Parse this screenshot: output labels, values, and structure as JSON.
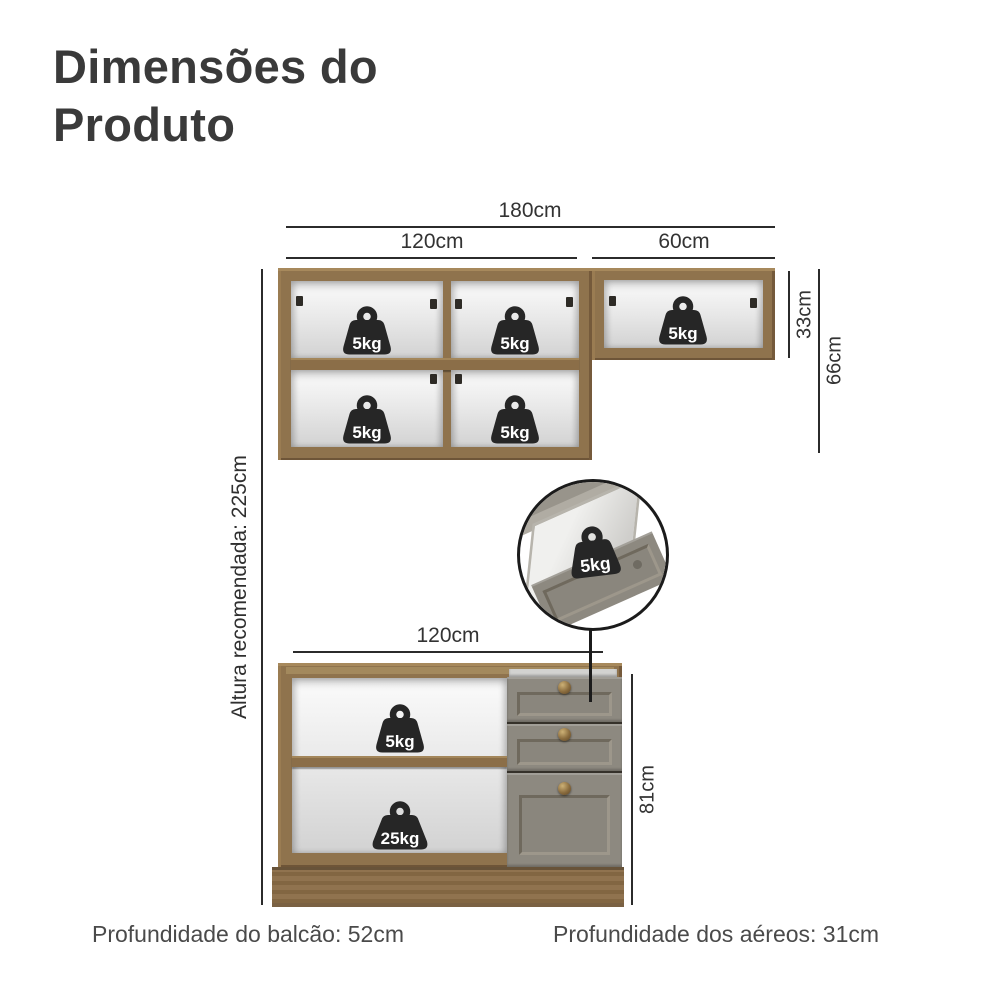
{
  "title": "Dimensões do Produto",
  "upper_cabinet": {
    "dims": {
      "total_width": "180cm",
      "left_width": "120cm",
      "right_width": "60cm",
      "right_height": "33cm",
      "total_height": "66cm"
    },
    "weights": [
      "5kg",
      "5kg",
      "5kg",
      "5kg",
      "5kg"
    ]
  },
  "side_note": "Altura recomendada: 225cm",
  "inset": {
    "weight": "5kg"
  },
  "lower_cabinet": {
    "dims": {
      "width": "120cm",
      "height": "81cm"
    },
    "weights": [
      "5kg",
      "25kg"
    ],
    "drawer_count": 3
  },
  "footer": {
    "counter_depth": "Profundidade do balcão: 52cm",
    "aerial_depth": "Profundidade dos aéreos: 31cm"
  },
  "colors": {
    "wood": "#8f734d",
    "drawer_gray": "#8d8980",
    "weight_black": "#262626",
    "dimension_line": "#2b2b2b"
  }
}
